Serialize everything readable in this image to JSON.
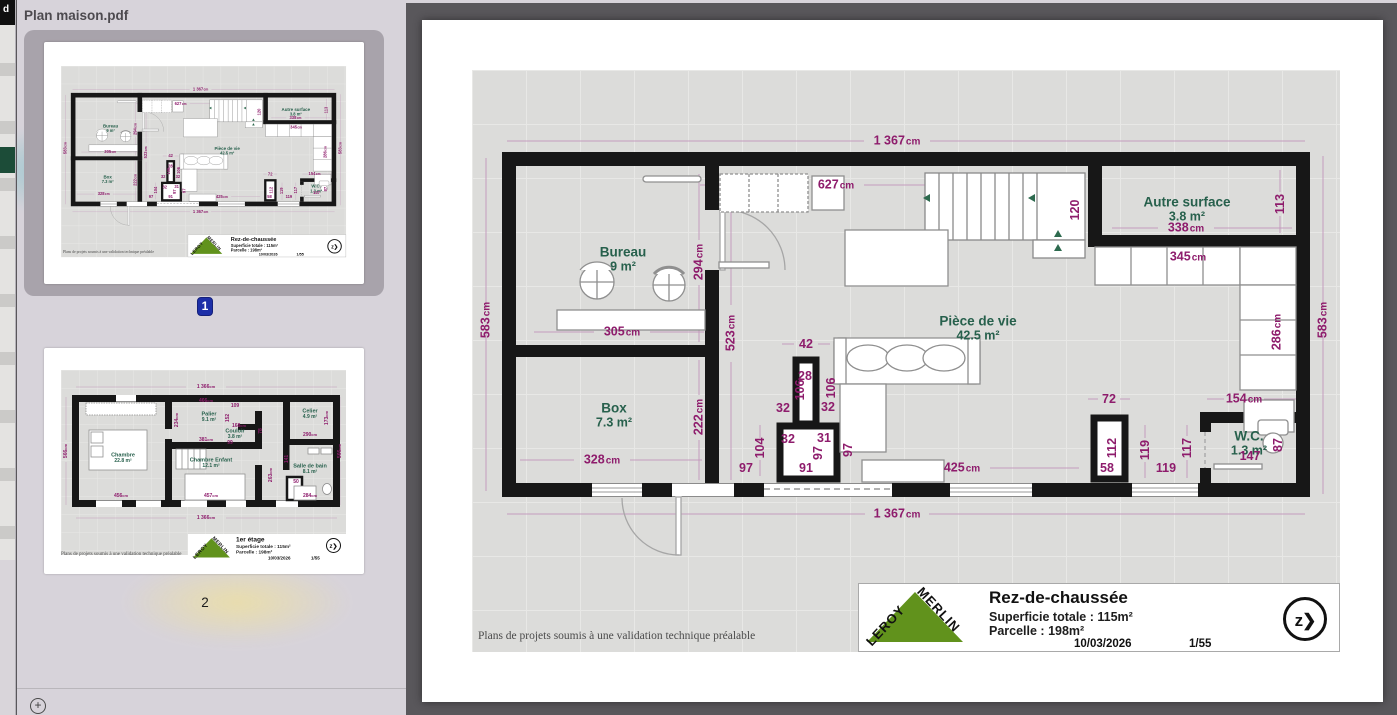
{
  "window": {
    "title": "Plan maison.pdf",
    "edge_fragment": "d"
  },
  "sidebar": {
    "pages": [
      {
        "number": "1",
        "selected": true
      },
      {
        "number": "2",
        "selected": false
      }
    ],
    "zoom_label": "+"
  },
  "colors": {
    "dimension_text": "#8e1c6c",
    "room_text": "#27604c",
    "wall": "#171717",
    "badge_blue": "#1d2fa8",
    "logo_green": "#61921c",
    "viewer_bg": "#59575b",
    "sidebar_bg": "#d7d3da",
    "plan_bg": "#dcdcda"
  },
  "page1": {
    "plan_title": "Rez-de-chaussée",
    "superficie": "Superficie totale : 115m²",
    "parcelle": "Parcelle : 198m²",
    "date": "10/03/2026",
    "page_ref": "1/55",
    "compass": "z❯",
    "brand_line1": "LEROY",
    "brand_line2": "MERLIN",
    "disclaimer": "Plans de projets soumis à une validation technique préalable",
    "rooms": [
      {
        "name": "Bureau",
        "area": "9 m²",
        "x": 151,
        "y": 190
      },
      {
        "name": "Box",
        "area": "7.3 m²",
        "x": 142,
        "y": 346
      },
      {
        "name": "Pièce de vie",
        "area": "42.5 m²",
        "x": 506,
        "y": 259
      },
      {
        "name": "Autre surface",
        "area": "3.8 m²",
        "x": 715,
        "y": 140
      },
      {
        "name": "W.C.",
        "area": "1.3 m²",
        "x": 777,
        "y": 374
      }
    ],
    "dims": [
      {
        "t": "1 367",
        "u": "cm",
        "x": 425,
        "y": 71
      },
      {
        "t": "1 367",
        "u": "cm",
        "x": 425,
        "y": 444
      },
      {
        "t": "583",
        "u": "cm",
        "x": 14,
        "y": 250,
        "r": 1
      },
      {
        "t": "583",
        "u": "cm",
        "x": 851,
        "y": 250,
        "r": 1
      },
      {
        "t": "627",
        "u": "cm",
        "x": 364,
        "y": 115
      },
      {
        "t": "120",
        "x": 603,
        "y": 140,
        "r": 1
      },
      {
        "t": "294",
        "u": "cm",
        "x": 227,
        "y": 192,
        "r": 1
      },
      {
        "t": "523",
        "u": "cm",
        "x": 259,
        "y": 263,
        "r": 1
      },
      {
        "t": "305",
        "u": "cm",
        "x": 150,
        "y": 262
      },
      {
        "t": "328",
        "u": "cm",
        "x": 130,
        "y": 390
      },
      {
        "t": "222",
        "u": "cm",
        "x": 227,
        "y": 347,
        "r": 1
      },
      {
        "t": "42",
        "x": 334,
        "y": 274
      },
      {
        "t": "28",
        "x": 333,
        "y": 306
      },
      {
        "t": "106",
        "x": 328,
        "y": 320,
        "r": 1
      },
      {
        "t": "106",
        "x": 359,
        "y": 318,
        "r": 1
      },
      {
        "t": "32",
        "x": 311,
        "y": 338
      },
      {
        "t": "32",
        "x": 356,
        "y": 337
      },
      {
        "t": "32",
        "x": 316,
        "y": 369
      },
      {
        "t": "31",
        "x": 352,
        "y": 368
      },
      {
        "t": "104",
        "x": 288,
        "y": 378,
        "r": 1
      },
      {
        "t": "97",
        "x": 274,
        "y": 398
      },
      {
        "t": "91",
        "x": 334,
        "y": 398
      },
      {
        "t": "97",
        "x": 346,
        "y": 383,
        "r": 1
      },
      {
        "t": "97",
        "x": 376,
        "y": 380,
        "r": 1
      },
      {
        "t": "425",
        "u": "cm",
        "x": 490,
        "y": 398
      },
      {
        "t": "345",
        "u": "cm",
        "x": 716,
        "y": 187
      },
      {
        "t": "338",
        "u": "cm",
        "x": 714,
        "y": 158
      },
      {
        "t": "113",
        "x": 808,
        "y": 134,
        "r": 1
      },
      {
        "t": "286",
        "u": "cm",
        "x": 805,
        "y": 262,
        "r": 1
      },
      {
        "t": "154",
        "u": "cm",
        "x": 772,
        "y": 329
      },
      {
        "t": "72",
        "x": 637,
        "y": 329
      },
      {
        "t": "112",
        "x": 640,
        "y": 378,
        "r": 1
      },
      {
        "t": "58",
        "x": 635,
        "y": 398
      },
      {
        "t": "119",
        "x": 673,
        "y": 380,
        "r": 1
      },
      {
        "t": "119",
        "x": 694,
        "y": 398
      },
      {
        "t": "117",
        "x": 715,
        "y": 378,
        "r": 1
      },
      {
        "t": "147",
        "x": 778,
        "y": 386
      },
      {
        "t": "87",
        "x": 806,
        "y": 375,
        "r": 1
      }
    ]
  },
  "page2": {
    "plan_title": "1er étage",
    "superficie": "Superficie totale : 115m²",
    "parcelle": "Parcelle : 198m²",
    "date": "10/03/2026",
    "page_ref": "1/55",
    "compass": "z❯",
    "disclaimer": "Plans de projets soumis à une validation technique préalable",
    "rooms": [
      {
        "name": "Chambre",
        "area": "22.8 m²",
        "x": 124,
        "y": 176
      },
      {
        "name": "Palier",
        "area": "9.1 m²",
        "x": 296,
        "y": 94
      },
      {
        "name": "Couloir",
        "area": "3.8 m²",
        "x": 348,
        "y": 128
      },
      {
        "name": "Celier",
        "area": "4.9 m²",
        "x": 498,
        "y": 88
      },
      {
        "name": "Chambre Enfant",
        "area": "12.1 m²",
        "x": 300,
        "y": 186
      },
      {
        "name": "Salle de bain",
        "area": "8.1 m²",
        "x": 498,
        "y": 198
      }
    ],
    "dims": [
      {
        "t": "1 366",
        "u": "cm",
        "x": 290,
        "y": 34
      },
      {
        "t": "1 366",
        "u": "cm",
        "x": 290,
        "y": 296
      },
      {
        "t": "566",
        "u": "cm",
        "x": 10,
        "y": 162,
        "r": 1
      },
      {
        "t": "566",
        "u": "cm",
        "x": 558,
        "y": 162,
        "r": 1
      },
      {
        "t": "466",
        "u": "cm",
        "x": 290,
        "y": 62
      },
      {
        "t": "109",
        "x": 348,
        "y": 72
      },
      {
        "t": "234",
        "u": "cm",
        "x": 232,
        "y": 100,
        "r": 1
      },
      {
        "t": "381",
        "u": "cm",
        "x": 290,
        "y": 140
      },
      {
        "t": "168",
        "u": "cm",
        "x": 356,
        "y": 112
      },
      {
        "t": "152",
        "x": 334,
        "y": 96,
        "r": 1
      },
      {
        "t": "99",
        "x": 338,
        "y": 146
      },
      {
        "t": "78",
        "x": 400,
        "y": 122,
        "r": 1
      },
      {
        "t": "290",
        "u": "cm",
        "x": 498,
        "y": 130
      },
      {
        "t": "173",
        "u": "cm",
        "x": 532,
        "y": 96,
        "r": 1
      },
      {
        "t": "141",
        "x": 452,
        "y": 178,
        "r": 1
      },
      {
        "t": "50",
        "x": 470,
        "y": 224
      },
      {
        "t": "263",
        "u": "cm",
        "x": 420,
        "y": 210,
        "r": 1
      },
      {
        "t": "456",
        "u": "cm",
        "x": 120,
        "y": 252
      },
      {
        "t": "457",
        "u": "cm",
        "x": 300,
        "y": 252
      },
      {
        "t": "284",
        "u": "cm",
        "x": 498,
        "y": 252
      }
    ]
  }
}
